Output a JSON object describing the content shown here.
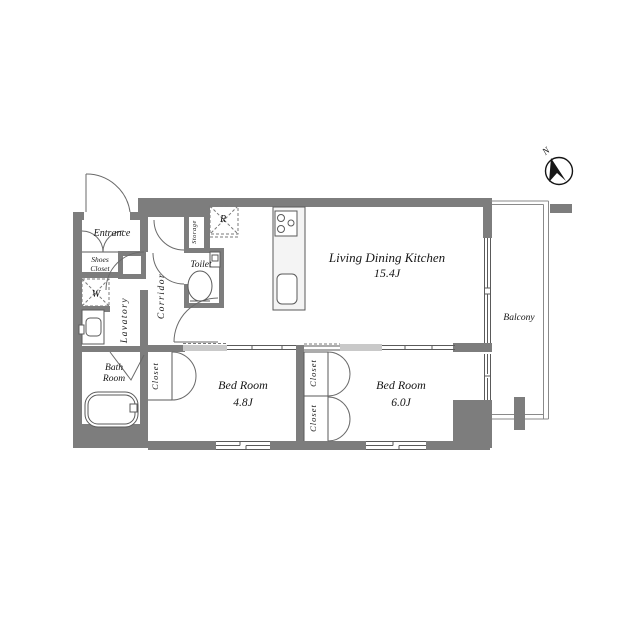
{
  "plan": {
    "rooms": {
      "entrance": "Entrance",
      "shoes_closet_line1": "Shoes",
      "shoes_closet_line2": "Closet",
      "washer": "W",
      "lavatory": "Lavatory",
      "bath_line1": "Bath",
      "bath_line2": "Room",
      "corridor": "Corridor",
      "storage": "Storage",
      "toilet": "Toilet",
      "refrigerator": "R",
      "ldk_name": "Living Dining Kitchen",
      "ldk_area": "15.4J",
      "bedroom1_name": "Bed Room",
      "bedroom1_area": "4.8J",
      "bedroom2_name": "Bed Room",
      "bedroom2_area": "6.0J",
      "balcony": "Balcony"
    },
    "closets": [
      "Closet",
      "Closet",
      "Closet"
    ],
    "compass": {
      "north": "N"
    },
    "colors": {
      "wall": "#7d7d7d",
      "line": "#5a5a5a",
      "sliding_panel": "#c9c9c9",
      "counter_fill": "#f4f4f4",
      "text": "#161616",
      "background": "#ffffff"
    }
  }
}
